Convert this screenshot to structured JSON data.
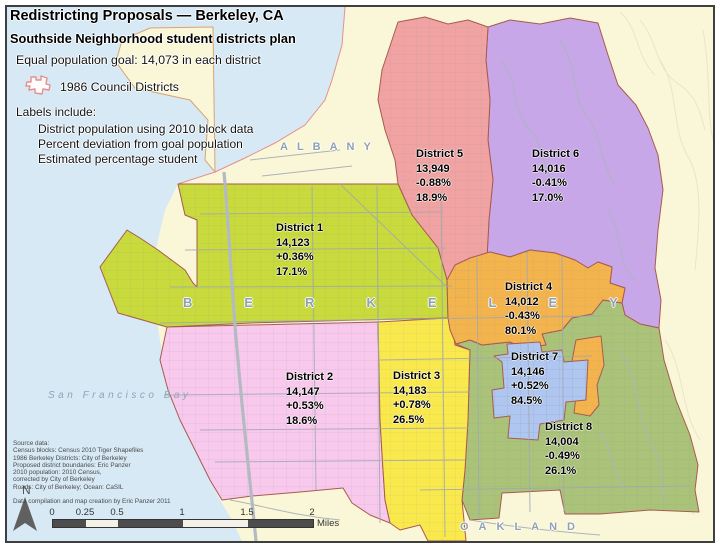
{
  "header": {
    "title": "Redistricting Proposals — Berkeley, CA",
    "subtitle": "Southside Neighborhood student districts plan",
    "goal_line": "Equal population goal: 14,073 in each district",
    "legend_label": "1986 Council Districts",
    "legend_icon": "council-district-outline-icon",
    "labels_heading": "Labels include:",
    "labels_items": [
      "District population using 2010 block data",
      "Percent deviation from goal population",
      "Estimated percentage student"
    ]
  },
  "districts": [
    {
      "name": "District 1",
      "population": "14,123",
      "deviation": "+0.36%",
      "students": "17.1%",
      "color": "#c8da3c"
    },
    {
      "name": "District 2",
      "population": "14,147",
      "deviation": "+0.53%",
      "students": "18.6%",
      "color": "#f8c9ec"
    },
    {
      "name": "District 3",
      "population": "14,183",
      "deviation": "+0.78%",
      "students": "26.5%",
      "color": "#fae94d"
    },
    {
      "name": "District 4",
      "population": "14,012",
      "deviation": "-0.43%",
      "students": "80.1%",
      "color": "#f4b44d"
    },
    {
      "name": "District 5",
      "population": "13,949",
      "deviation": "-0.88%",
      "students": "18.9%",
      "color": "#f0a3a2"
    },
    {
      "name": "District 6",
      "population": "14,016",
      "deviation": "-0.41%",
      "students": "17.0%",
      "color": "#c7a7e7"
    },
    {
      "name": "District 7",
      "population": "14,146",
      "deviation": "+0.52%",
      "students": "84.5%",
      "color": "#afc7f0"
    },
    {
      "name": "District 8",
      "population": "14,004",
      "deviation": "-0.49%",
      "students": "26.1%",
      "color": "#aac379"
    }
  ],
  "city_labels": {
    "albany": "ALBANY",
    "berkeley": "BERKELEY",
    "oakland": "OAKLAND",
    "bay": "San Francisco Bay"
  },
  "north_label": "N",
  "north_icon": "north-arrow-icon",
  "scale_bar": {
    "ticks": [
      "0",
      "0.25",
      "0.5",
      "1",
      "1.5",
      "2"
    ],
    "unit_label": "Miles"
  },
  "source_box": {
    "lines": [
      "Source data:",
      "Census blocks: Census 2010 Tiger Shapefiles",
      "1986 Berkeley Districts: City of Berkeley",
      "Proposed district boundaries: Eric Panzer",
      "2010 population: 2010 Census,",
      "corrected by City of Berkeley",
      "Roads: City of Berkeley; Ocean: CaSIL"
    ],
    "credit": "Data compilation and map creation by Eric Panzer 2011"
  },
  "colors": {
    "bay": "#d7e9f5",
    "land": "#faf7d8",
    "district_boundary": "#a85a50",
    "council_1986_line": "#e58f8f",
    "road": "#9fa8b2"
  }
}
